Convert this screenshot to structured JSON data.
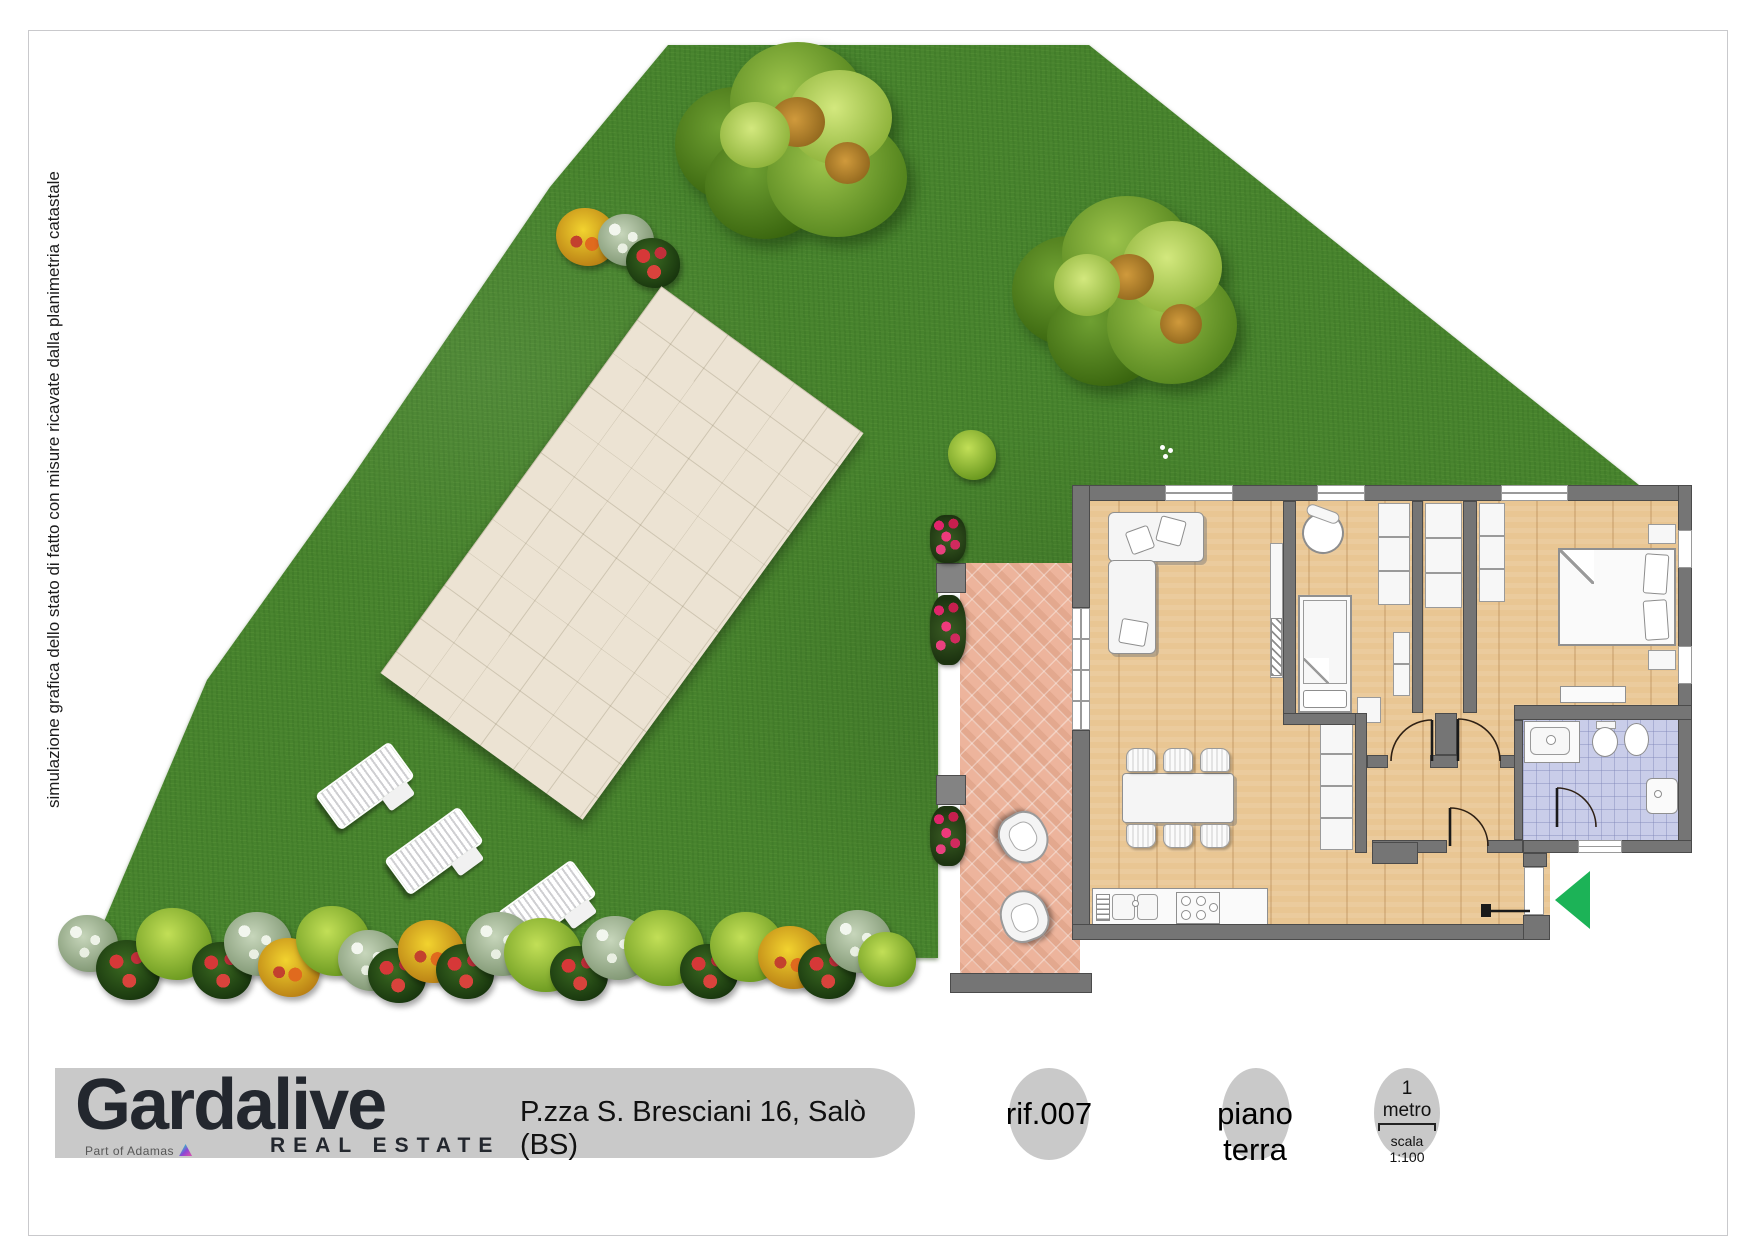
{
  "note": {
    "text": "simulazione grafica dello stato di fatto con misure ricavate dalla planimetria catastale"
  },
  "footer": {
    "brand": "Gardalive",
    "brand_tagline": "REAL ESTATE",
    "brand_subtext": "Part of Adamas",
    "address": "P.zza S. Bresciani 16, Salò (BS)",
    "reference": "rif.007",
    "floor_label": "piano terra",
    "scale_length_label": "1 metro",
    "scale_ratio_label": "scala 1:100"
  },
  "colors": {
    "grass": "#47832d",
    "pool_water": "#45d2e2",
    "pool_border": "#3d7ee5",
    "pool_deck": "#ece3d3",
    "terrace_tiles": "#edb49c",
    "walls": "#757575",
    "wood_floor": "#e9c693",
    "bathroom_floor": "#c9cde9",
    "entrance_arrow": "#1cb357",
    "footer_bar": "#c9c9c9"
  }
}
